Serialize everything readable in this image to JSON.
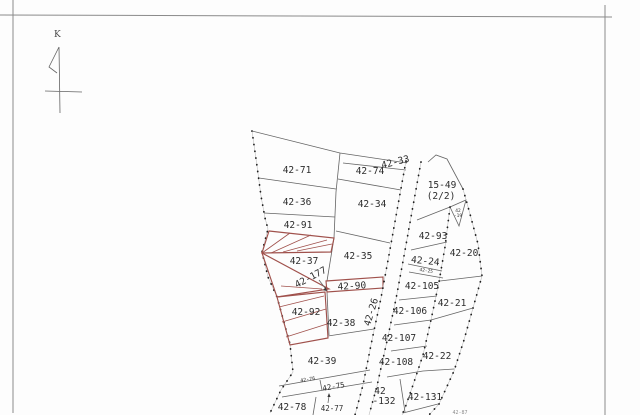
{
  "colors": {
    "highlight_red": "#a0514c",
    "boundary_gray": "#646464",
    "dot_black": "#1e1e1e"
  },
  "north_arrow": {
    "label": "K"
  },
  "road": {
    "label": "42-26"
  },
  "labels": {
    "north": "K",
    "l71": "42-71",
    "l36": "42-36",
    "l91": "42-91",
    "l37": "42-37",
    "l177": "42-177",
    "l92": "42-92",
    "l74": "42-74",
    "l33": "42-33",
    "l34": "42-34",
    "l35": "42-35",
    "l90": "42-90",
    "l38": "42-38",
    "l39": "42-39",
    "l76": "42-76",
    "l75": "42-75",
    "l78": "42-78",
    "l77": "42-77",
    "road": "42-26",
    "l1549a": "15-49",
    "l1549b": "(2/2)",
    "l19a": "42",
    "l19b": "-19",
    "l93": "42-93",
    "l20": "42-20",
    "l24": "42-24",
    "l25": "42-25",
    "l105": "42-105",
    "l106": "42-106",
    "l21": "42-21",
    "l107": "42-107",
    "l108": "42-108",
    "l22": "42-22",
    "l132a": "42",
    "l132b": "-132",
    "l131": "42-131",
    "l87": "42-87"
  }
}
